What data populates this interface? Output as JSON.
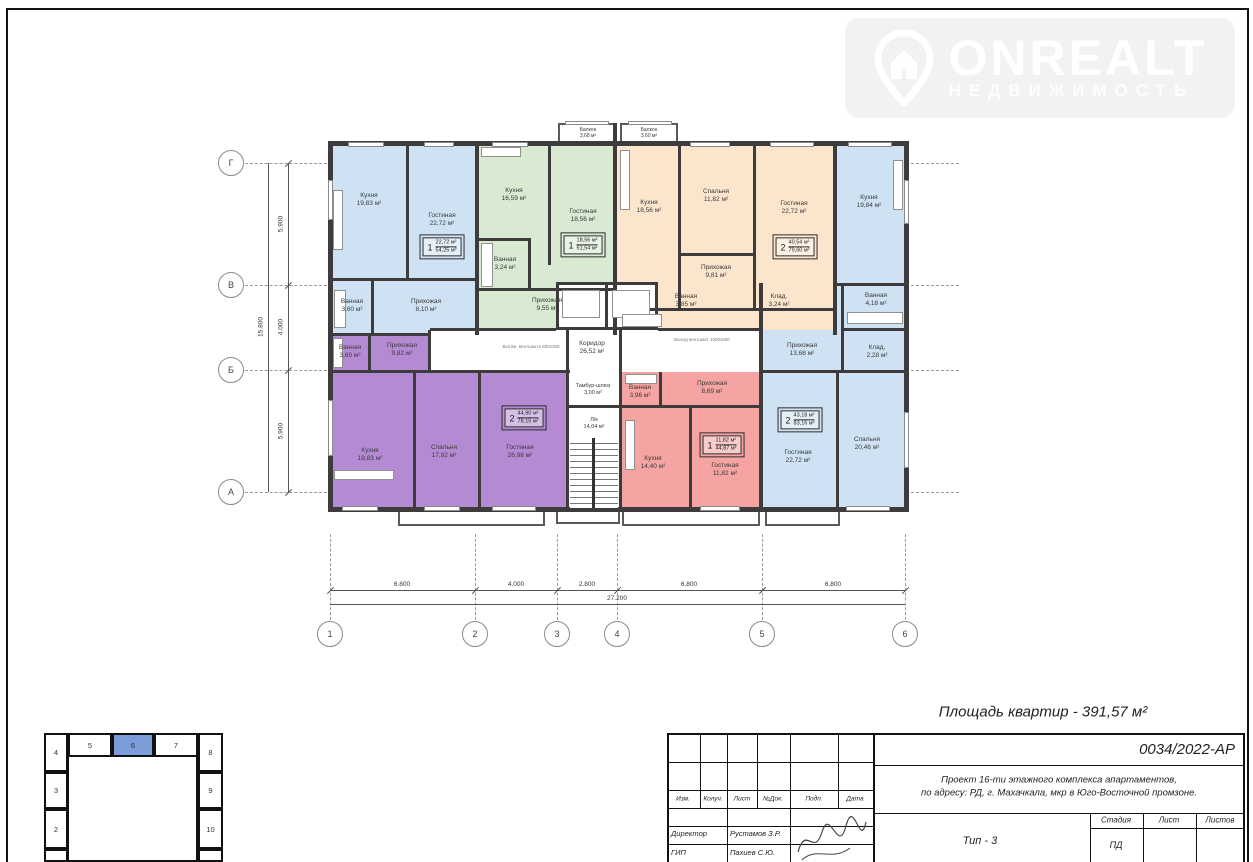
{
  "logo": {
    "brand": "ONREALT",
    "tagline": "НЕДВИЖИМОСТЬ"
  },
  "plan": {
    "balconies": [
      {
        "label": "Балкон",
        "area": "3,68 м²"
      },
      {
        "label": "Балкон",
        "area": "3,60 м²"
      }
    ],
    "apartments": [
      {
        "color": "#cfe2f3",
        "stamp_rooms": "1",
        "stamp_living": "22,72 м²",
        "stamp_total": "54,25 м²",
        "rooms": [
          {
            "label": "Кухня",
            "area": "19,83 м²"
          },
          {
            "label": "Гостиная",
            "area": "22,72 м²"
          },
          {
            "label": "Ванная",
            "area": "3,60 м²"
          },
          {
            "label": "Прихожая",
            "area": "8,10 м²"
          }
        ]
      },
      {
        "color": "#d9ead3",
        "stamp_rooms": "1",
        "stamp_living": "18,56 м²",
        "stamp_total": "51,54 м²",
        "rooms": [
          {
            "label": "Кухня",
            "area": "16,59 м²"
          },
          {
            "label": "Гостиная",
            "area": "18,56 м²"
          },
          {
            "label": "Ванная",
            "area": "3,24 м²"
          },
          {
            "label": "Прихожая",
            "area": "9,55 м²"
          }
        ]
      },
      {
        "color": "#fce5cd",
        "stamp_rooms": "2",
        "stamp_living": "40,54 м²",
        "stamp_total": "79,60 м²",
        "rooms": [
          {
            "label": "Кухня",
            "area": "18,56 м²"
          },
          {
            "label": "Спальня",
            "area": "11,82 м²"
          },
          {
            "label": "Гостиная",
            "area": "22,72 м²"
          },
          {
            "label": "Прихожая",
            "area": "9,81 м²"
          },
          {
            "label": "Ванная",
            "area": "3,85 м²"
          },
          {
            "label": "Клад.",
            "area": "3,24 м²"
          }
        ]
      },
      {
        "color": "#cfe2f3",
        "stamp_rooms": "2",
        "stamp_living": "43,18 м²",
        "stamp_total": "83,16 м²",
        "rooms": [
          {
            "label": "Кухня",
            "area": "19,84 м²"
          },
          {
            "label": "Прихожая",
            "area": "13,68 м²"
          },
          {
            "label": "Ванная",
            "area": "4,18 м²"
          },
          {
            "label": "Клад.",
            "area": "2,28 м²"
          },
          {
            "label": "Гостиная",
            "area": "22,72 м²"
          },
          {
            "label": "Спальня",
            "area": "20,46 м²"
          }
        ]
      },
      {
        "color": "#b48ad2",
        "stamp_rooms": "2",
        "stamp_living": "44,90 м²",
        "stamp_total": "78,15 м²",
        "rooms": [
          {
            "label": "Ванная",
            "area": "3,60 м²"
          },
          {
            "label": "Прихожая",
            "area": "9,82 м²"
          },
          {
            "label": "Кухня",
            "area": "19,83 м²"
          },
          {
            "label": "Спальня",
            "area": "17,92 м²"
          },
          {
            "label": "Гостиная",
            "area": "26,98 м²"
          }
        ]
      },
      {
        "color": "#f5a3a3",
        "stamp_rooms": "1",
        "stamp_living": "11,82 м²",
        "stamp_total": "44,87 м²",
        "rooms": [
          {
            "label": "Ванная",
            "area": "3,96 м²"
          },
          {
            "label": "Прихожая",
            "area": "8,69 м²"
          },
          {
            "label": "Кухня",
            "area": "14,40 м²"
          },
          {
            "label": "Гостиная",
            "area": "11,82 м²"
          }
        ]
      }
    ],
    "core": {
      "corridor": {
        "label": "Коридор",
        "area": "26,52 м²"
      },
      "tambour": {
        "label": "Тамбур-шлюз",
        "area": "3,00 м²"
      },
      "stair": {
        "label": "Л/к",
        "area": "14,04 м²"
      },
      "vent_left": "Вытяж. вентшахта 600х300",
      "vent_right": "Выход вентшахт 1000х600"
    },
    "axes": {
      "rows": [
        "Г",
        "В",
        "Б",
        "А"
      ],
      "cols": [
        "1",
        "2",
        "3",
        "4",
        "5",
        "6"
      ],
      "row_dims": [
        "5.900",
        "4.000",
        "5.900"
      ],
      "row_total": "15.800",
      "col_dims": [
        "6.800",
        "4.000",
        "2.800",
        "6.800",
        "6.800"
      ],
      "col_total": "27.200"
    }
  },
  "title_block": {
    "area_summary": "Площадь квартир - 391,57 м²",
    "doc_number": "0034/2022-АР",
    "project_line1": "Проект 16-ти этажного комплекса апартаментов,",
    "project_line2": "по адресу: РД, г. Махачкала, мкр в Юго-Восточной промзоне.",
    "type_label": "Тип - 3",
    "stage_header": "Стадия",
    "sheet_header": "Лист",
    "sheets_header": "Листов",
    "stage_value": "ПД",
    "cols": [
      "Изм.",
      "Колуч.",
      "Лист",
      "№Док.",
      "Подп.",
      "Дата"
    ],
    "sign_rows": [
      {
        "role": "Директор",
        "name": "Рустамов З.Р."
      },
      {
        "role": "ГИП",
        "name": "Пахиев С.Ю."
      }
    ]
  },
  "key_plan": {
    "top": [
      "4",
      "5",
      "6",
      "7",
      "8"
    ],
    "left": [
      "3",
      "2"
    ],
    "right": [
      "9",
      "10"
    ],
    "highlighted": "6"
  }
}
